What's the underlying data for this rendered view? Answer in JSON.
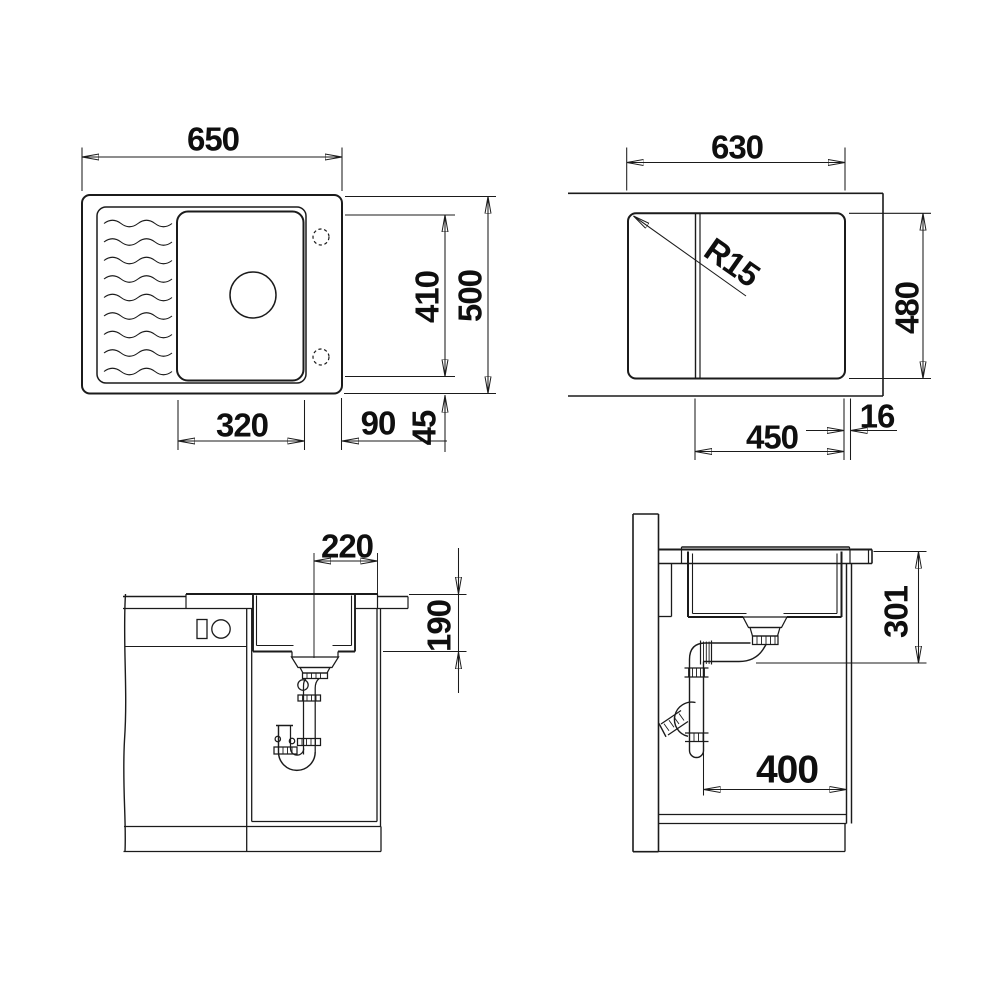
{
  "drawing": {
    "background": "#ffffff",
    "line_color": "#1b1b1b"
  },
  "views": {
    "top": {
      "overall_width": "650",
      "basin_length": "410",
      "overall_depth": "500",
      "basin_width": "320",
      "drainer_edge": "90",
      "rim_edge": "45"
    },
    "cutout": {
      "width": "630",
      "corner_radius": "R15",
      "depth": "480",
      "inner_width": "450",
      "edge_offset": "16"
    },
    "front_section": {
      "drain_offset": "220",
      "basin_depth": "190"
    },
    "side_section": {
      "install_depth": "301",
      "cabinet_clearance": "400"
    }
  }
}
